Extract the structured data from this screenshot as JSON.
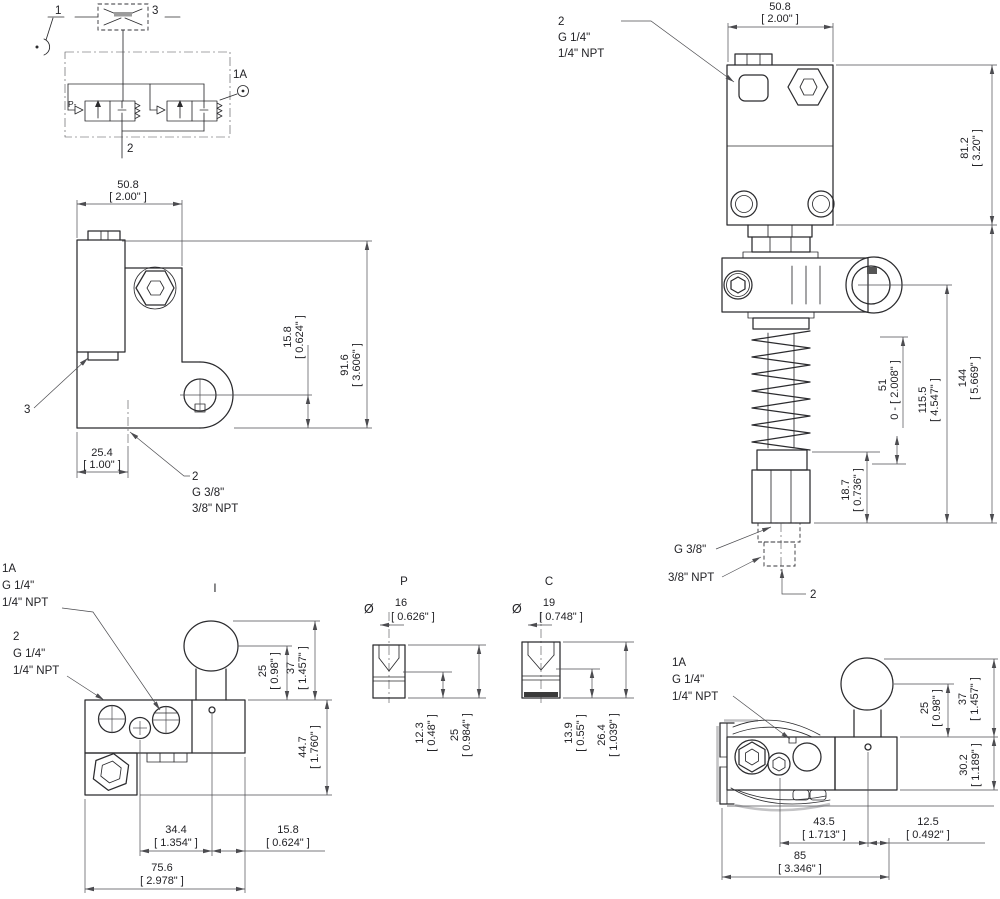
{
  "schematic": {
    "item1": "1",
    "item3": "3",
    "item1a": "1A",
    "item2": "2",
    "port_p": "P-"
  },
  "side_view": {
    "width_mm": "50.8",
    "width_in": "[ 2.00\" ]",
    "hole_mm": "15.8",
    "hole_in": "[ 0.624\" ]",
    "height_mm": "91.6",
    "height_in": "[ 3.606\" ]",
    "base_mm": "25.4",
    "base_in": "[ 1.00\" ]",
    "callout_3": "3",
    "callout_2_l1": "2",
    "callout_2_l2": "G 3/8\"",
    "callout_2_l3": "3/8\" NPT"
  },
  "front_view": {
    "callout_2_l1": "2",
    "callout_2_l2": "G 1/4\"",
    "callout_2_l3": "1/4\" NPT",
    "width_mm": "50.8",
    "width_in": "[ 2.00\" ]",
    "body_mm": "81.2",
    "body_in": "[ 3.20\" ]",
    "stroke_mm": "51",
    "stroke_in": "0 - [ 2.008\" ]",
    "mid_mm": "115.5",
    "mid_in": "[ 4.547\" ]",
    "total_mm": "144",
    "total_in": "[ 5.669\" ]",
    "nut_mm": "18.7",
    "nut_in": "[ 0.736\" ]",
    "port_g": "G 3/8\"",
    "port_npt": "3/8\" NPT",
    "callout_2b": "2"
  },
  "top_view": {
    "callout_1a_l1": "1A",
    "callout_1a_l2": "G 1/4\"",
    "callout_1a_l3": "1/4\" NPT",
    "callout_2_l1": "2",
    "callout_2_l2": "G 1/4\"",
    "callout_2_l3": "1/4\" NPT",
    "lever_label": "I",
    "ballc_mm": "25",
    "ballc_in": "[ 0.98\" ]",
    "ballt_mm": "37",
    "ballt_in": "[ 1.457\" ]",
    "body_mm": "44.7",
    "body_in": "[ 1.760\" ]",
    "pitch_mm": "34.4",
    "pitch_in": "[ 1.354\" ]",
    "edge_mm": "15.8",
    "edge_in": "[ 0.624\" ]",
    "width_mm": "75.6",
    "width_in": "[ 2.978\" ]"
  },
  "p_detail": {
    "label": "P",
    "dia_symbol": "Ø",
    "dia_mm": "16",
    "dia_in": "[ 0.626\" ]",
    "seat_mm": "12.3",
    "seat_in": "[ 0.48\" ]",
    "height_mm": "25",
    "height_in": "[ 0.984\" ]"
  },
  "c_detail": {
    "label": "C",
    "dia_symbol": "Ø",
    "dia_mm": "19",
    "dia_in": "[ 0.748\" ]",
    "seat_mm": "13.9",
    "seat_in": "[ 0.55\" ]",
    "height_mm": "26.4",
    "height_in": "[ 1.039\" ]"
  },
  "rear_view": {
    "callout_1a_l1": "1A",
    "callout_1a_l2": "G 1/4\"",
    "callout_1a_l3": "1/4\" NPT",
    "ballc_mm": "25",
    "ballc_in": "[ 0.98\" ]",
    "ballt_mm": "37",
    "ballt_in": "[ 1.457\" ]",
    "body_mm": "30.2",
    "body_in": "[ 1.189\" ]",
    "offset_mm": "43.5",
    "offset_in": "[ 1.713\" ]",
    "pin_mm": "12.5",
    "pin_in": "[ 0.492\" ]",
    "width_mm": "85",
    "width_in": "[ 3.346\" ]"
  }
}
